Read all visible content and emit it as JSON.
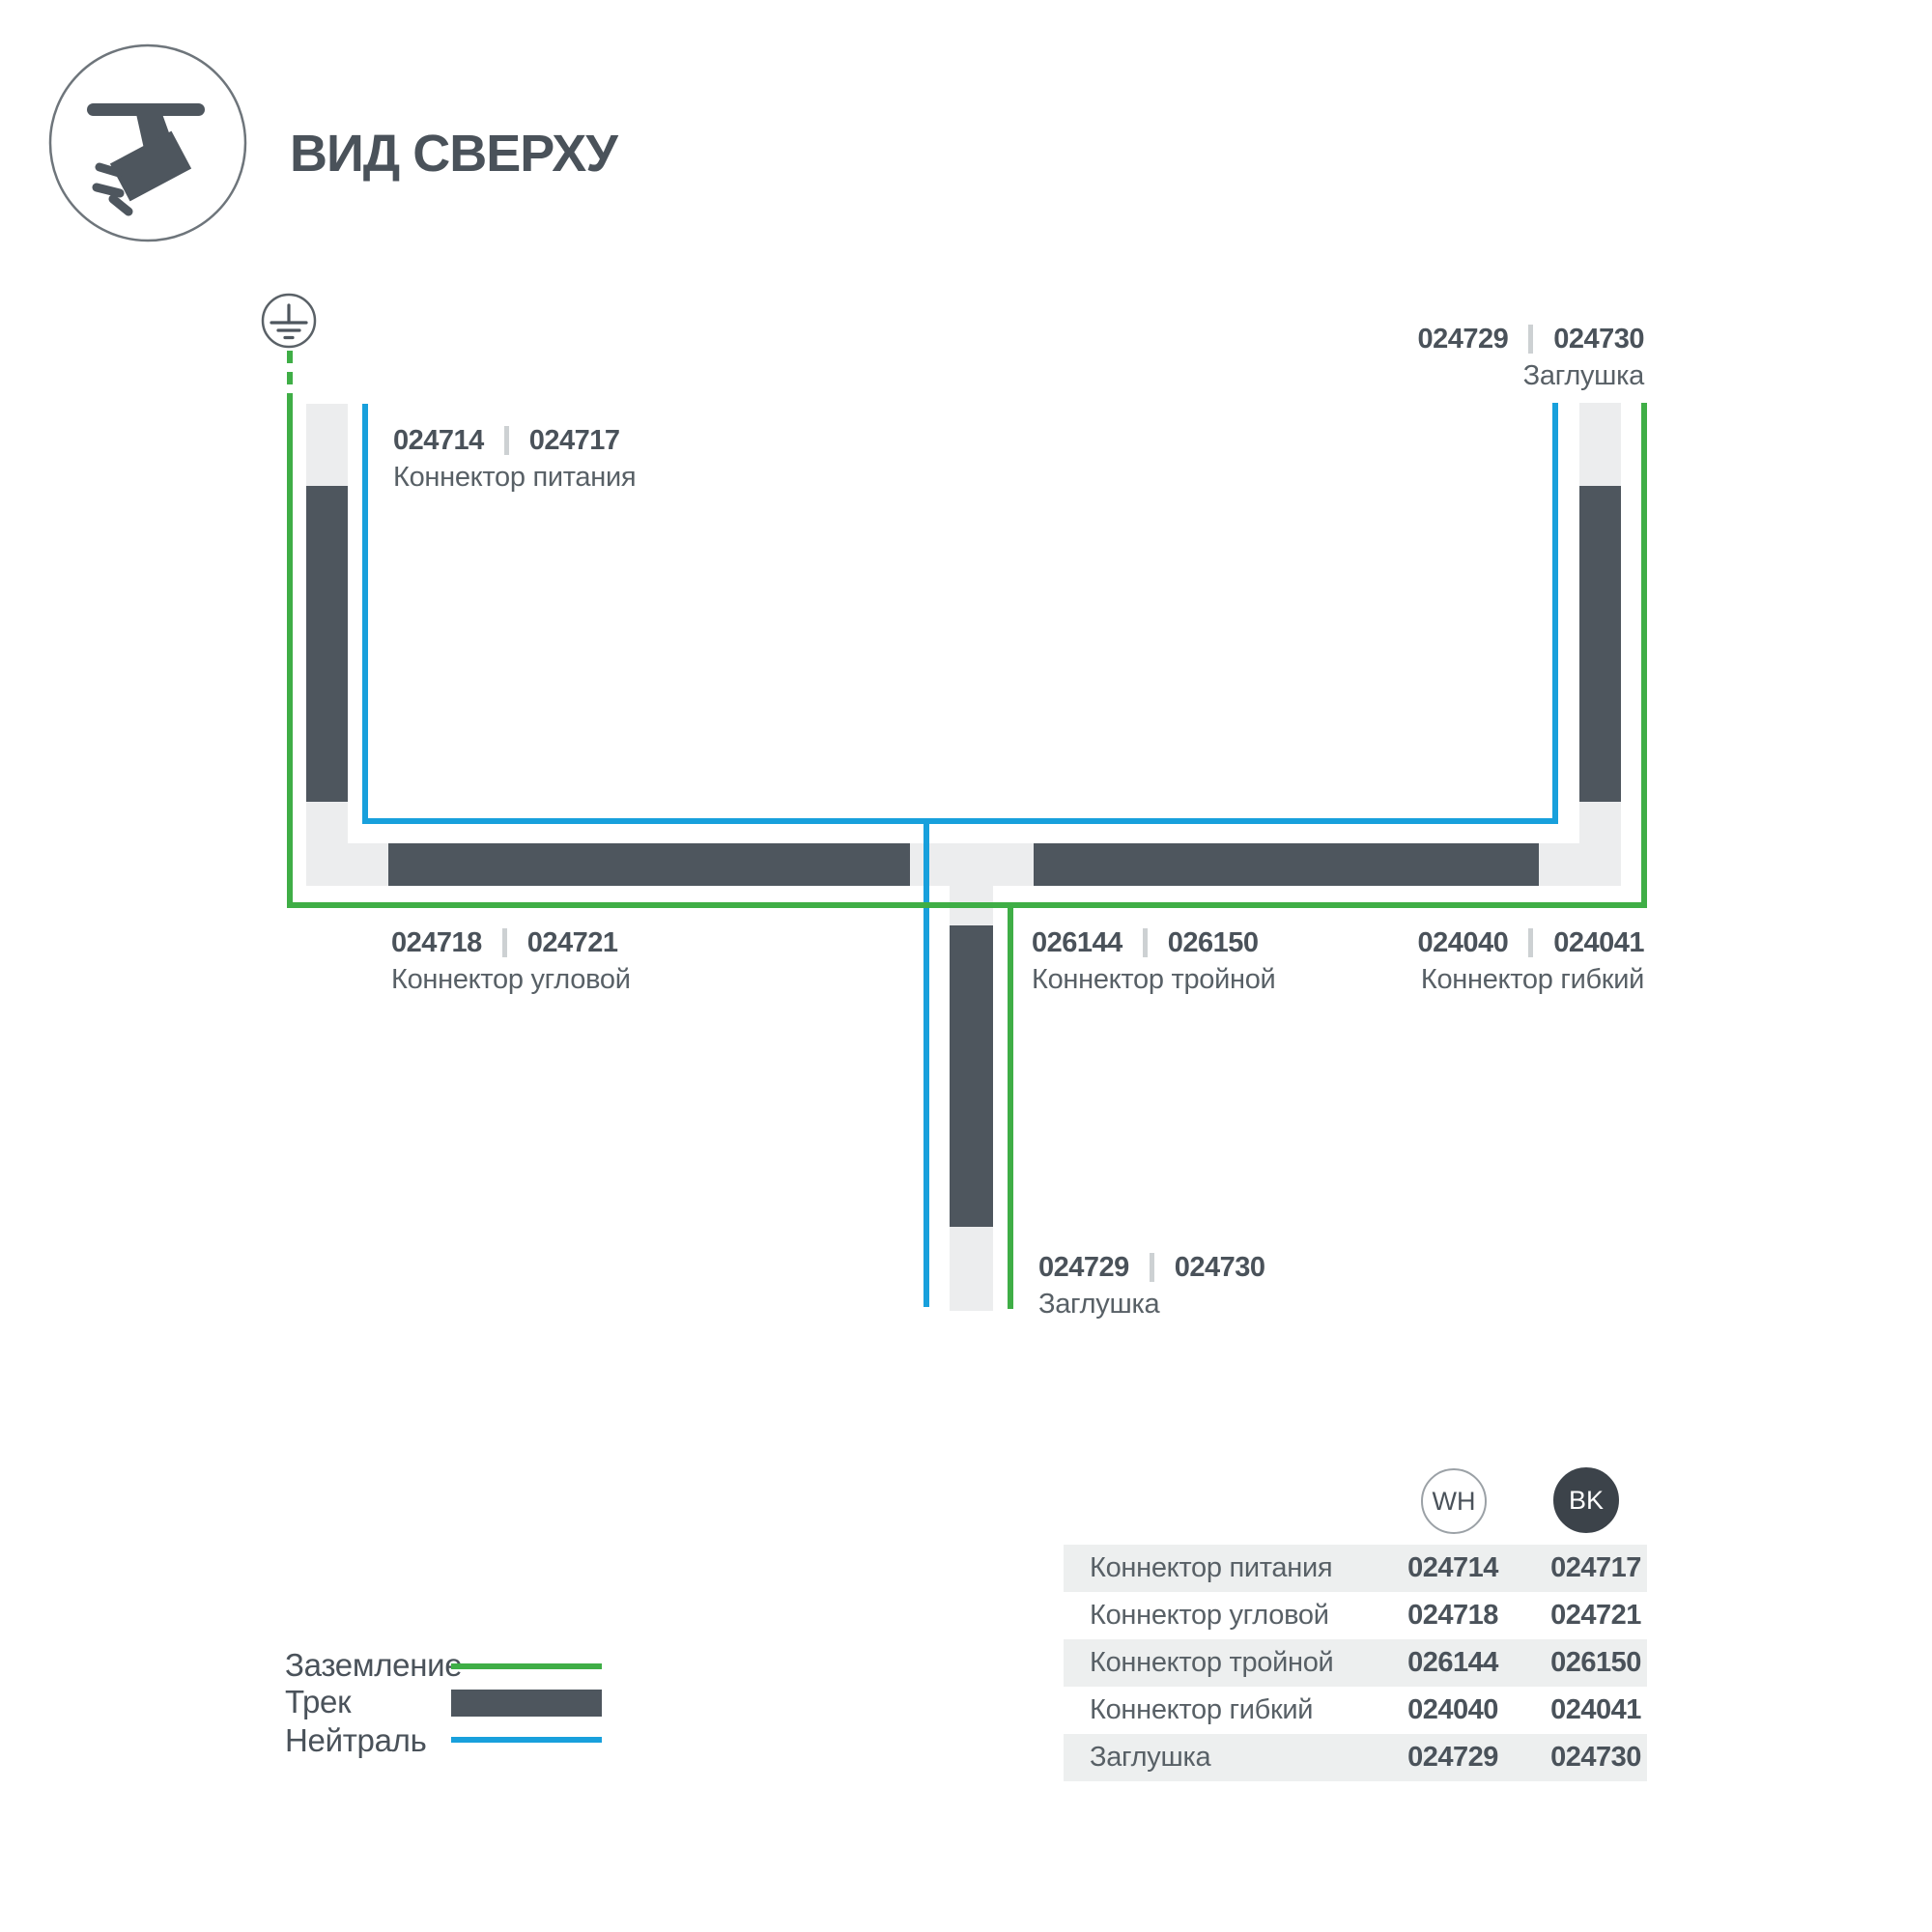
{
  "header": {
    "title": "ВИД СВЕРХУ",
    "icon": "track-spotlight-icon"
  },
  "colors": {
    "track": "#4E565E",
    "rail": "#ECEDEE",
    "ground": "#3FAE46",
    "neutral": "#18A0DC"
  },
  "diagram": {
    "ground_symbol": "earth-ground-icon",
    "labels": [
      {
        "code_wh": "024714",
        "code_bk": "024717",
        "name": "Коннектор питания"
      },
      {
        "code_wh": "024729",
        "code_bk": "024730",
        "name": "Заглушка"
      },
      {
        "code_wh": "024718",
        "code_bk": "024721",
        "name": "Коннектор угловой"
      },
      {
        "code_wh": "026144",
        "code_bk": "026150",
        "name": "Коннектор тройной"
      },
      {
        "code_wh": "024040",
        "code_bk": "024041",
        "name": "Коннектор гибкий"
      },
      {
        "code_wh": "024729",
        "code_bk": "024730",
        "name": "Заглушка"
      }
    ]
  },
  "legend": {
    "items": [
      {
        "label": "Заземление",
        "swatch": "ground-line"
      },
      {
        "label": "Трек",
        "swatch": "track-bar"
      },
      {
        "label": "Нейтраль",
        "swatch": "neutral-line"
      }
    ]
  },
  "table": {
    "columns": [
      "WH",
      "BK"
    ],
    "rows": [
      {
        "name": "Коннектор питания",
        "wh": "024714",
        "bk": "024717"
      },
      {
        "name": "Коннектор угловой",
        "wh": "024718",
        "bk": "024721"
      },
      {
        "name": "Коннектор тройной",
        "wh": "026144",
        "bk": "026150"
      },
      {
        "name": "Коннектор гибкий",
        "wh": "024040",
        "bk": "024041"
      },
      {
        "name": "Заглушка",
        "wh": "024729",
        "bk": "024730"
      }
    ]
  }
}
